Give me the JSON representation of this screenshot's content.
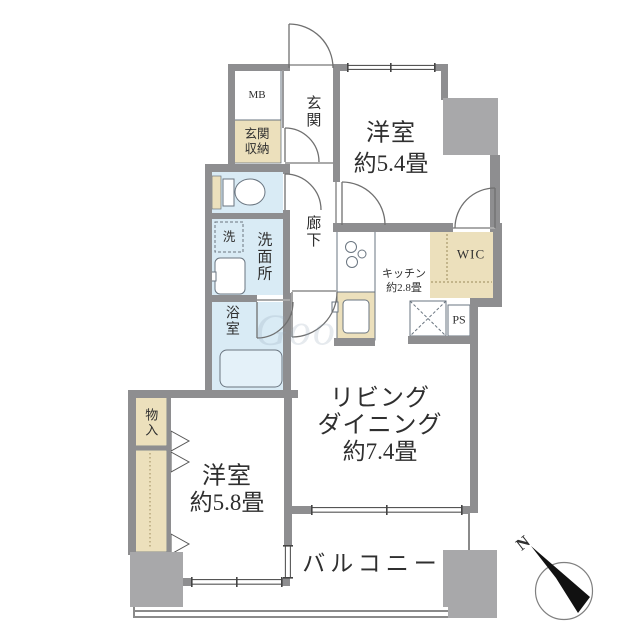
{
  "plan": {
    "labels": {
      "mb": "MB",
      "genkan": "玄関",
      "genkan_shuno_l1": "玄関",
      "genkan_shuno_l2": "収納",
      "yoshitsu54_l1": "洋室",
      "yoshitsu54_l2": "約5.4畳",
      "roka": "廊下",
      "sen": "洗",
      "senmenjo": "洗面所",
      "yokushitsu": "浴室",
      "kitchen_l1": "キッチン",
      "kitchen_l2": "約2.8畳",
      "wic": "WIC",
      "ps": "PS",
      "ld_l1": "リビング",
      "ld_l2": "ダイニング",
      "ld_l3": "約7.4畳",
      "monoire": "物入",
      "yoshitsu58_l1": "洋室",
      "yoshitsu58_l2": "約5.8畳",
      "balcony": "バルコニー",
      "north": "N",
      "watermark": "Goo"
    },
    "colors": {
      "wall": "#8e8e90",
      "pillar": "#a8a8aa",
      "wet_area": "#d9ebf5",
      "storage": "#ece0bc",
      "fixture_line": "#6a7580",
      "text": "#2f2f2f"
    }
  }
}
